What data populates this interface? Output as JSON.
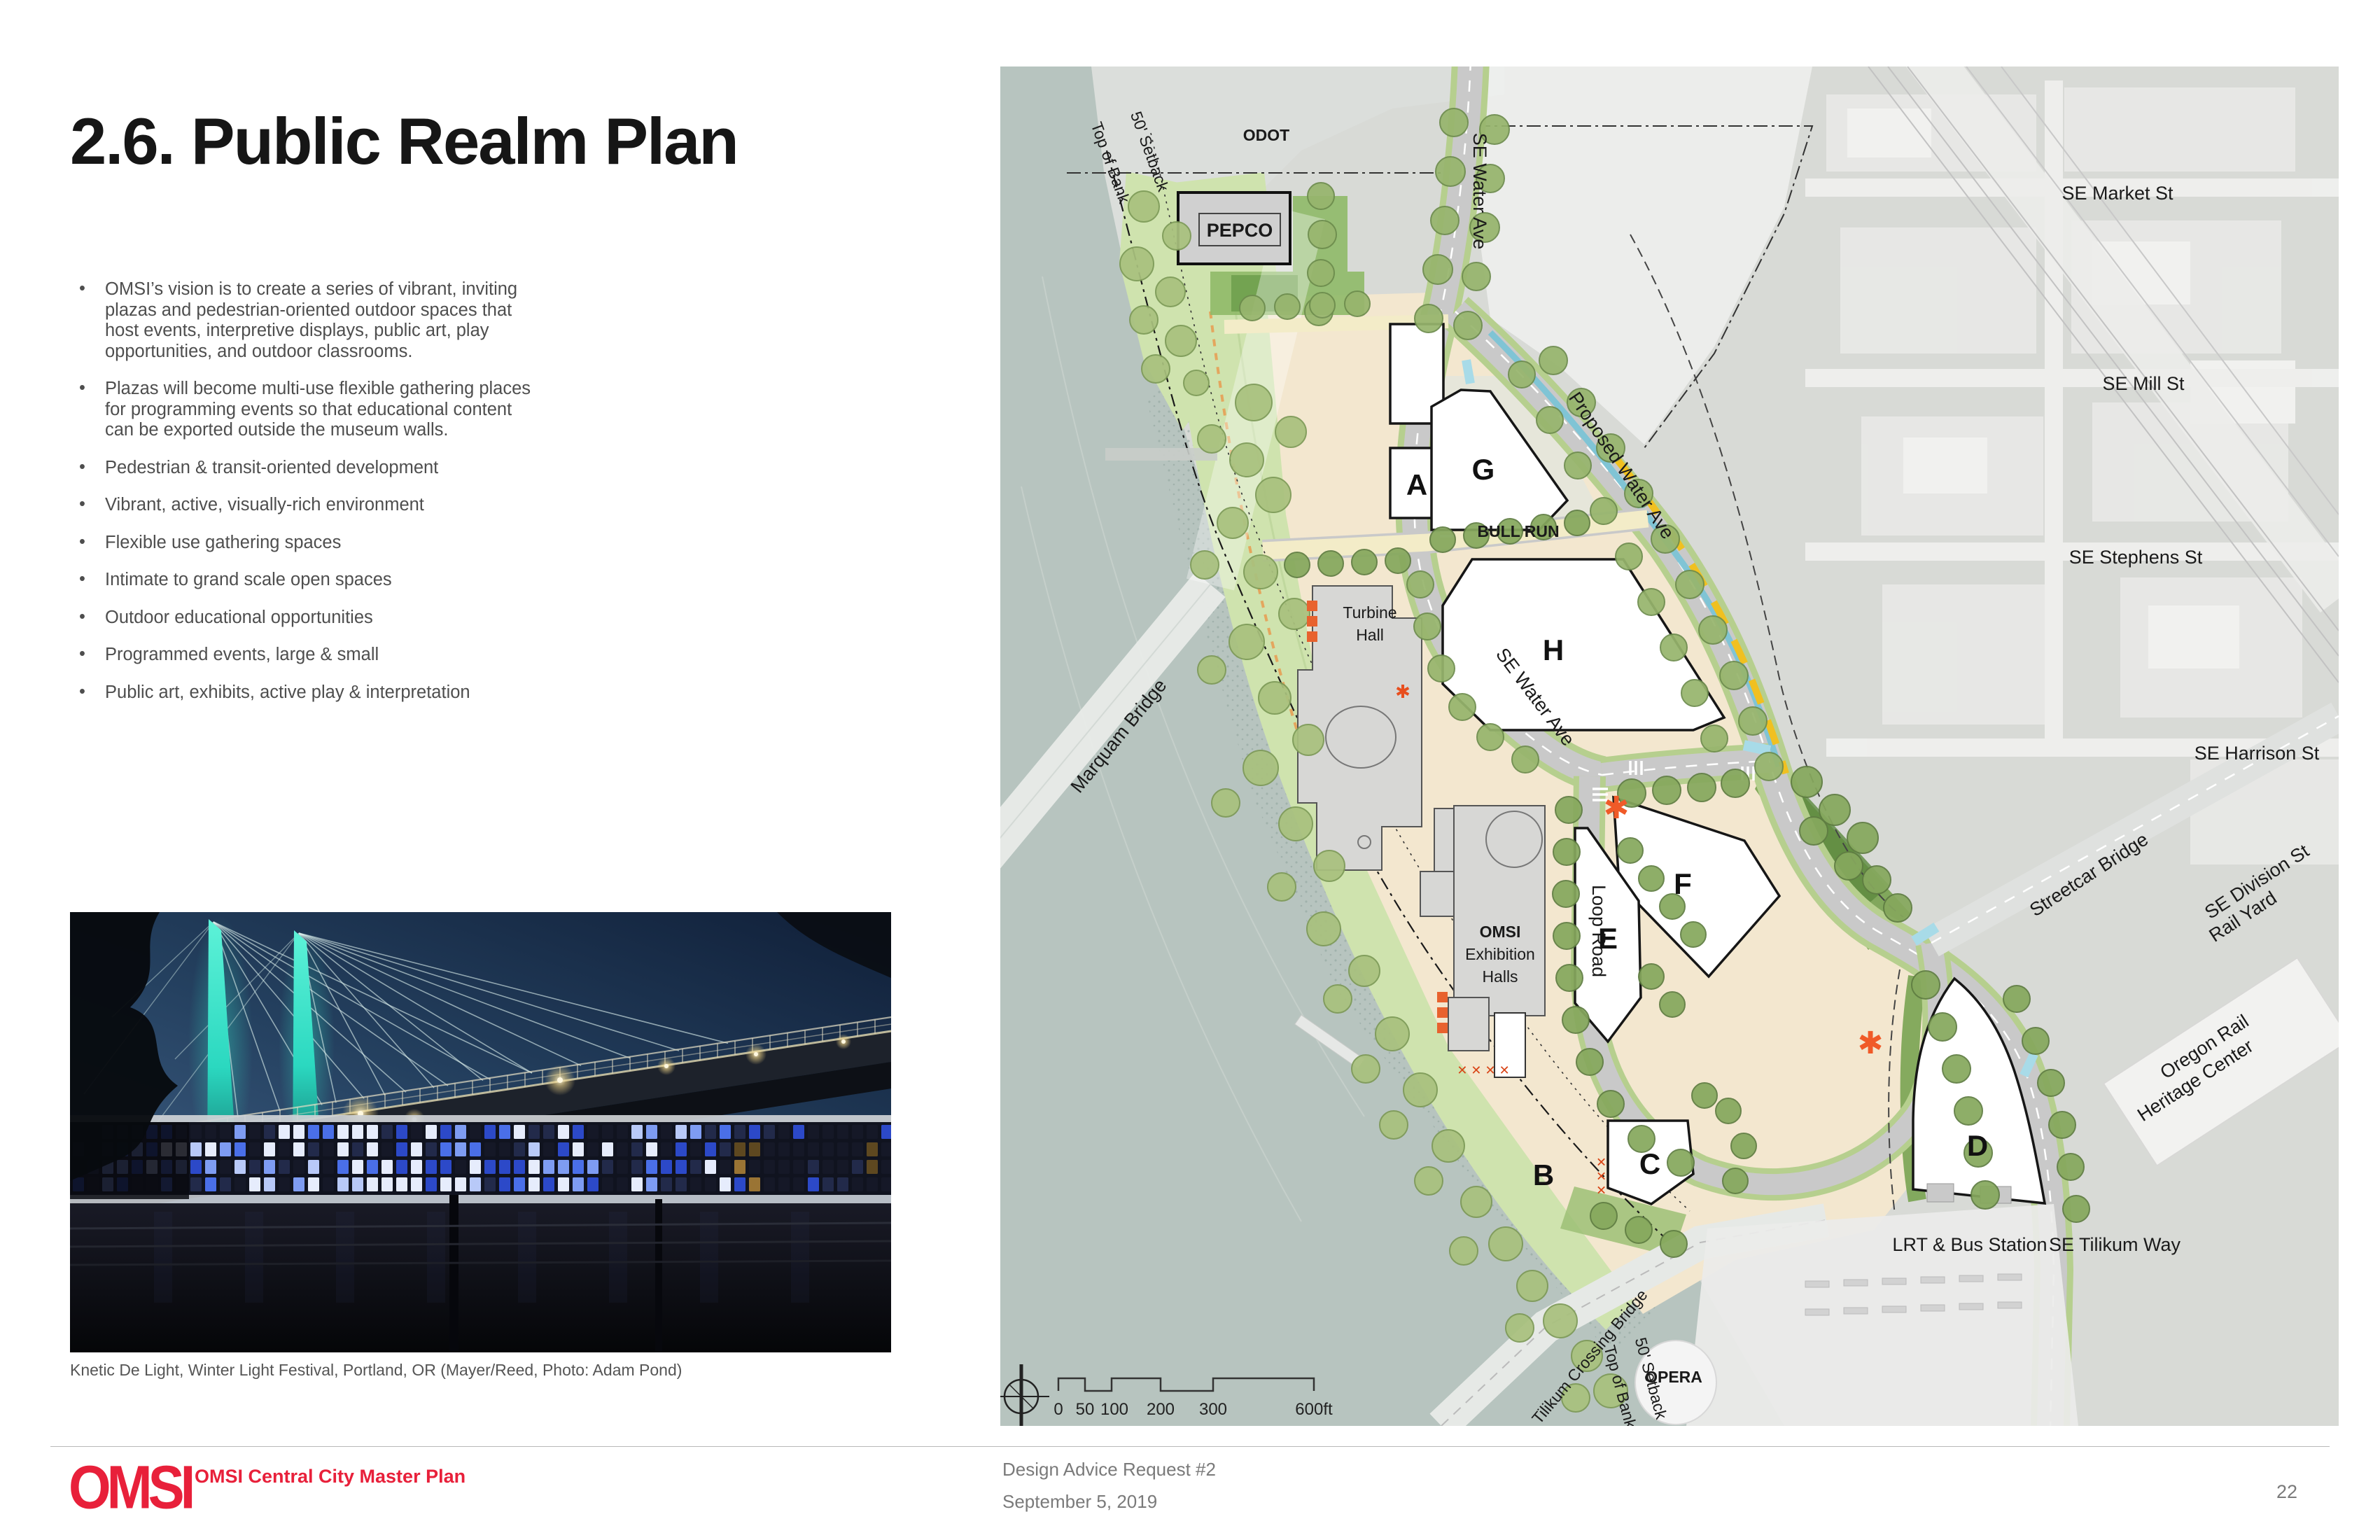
{
  "header": {
    "title": "2.6. Public Realm Plan"
  },
  "bullets": {
    "items": [
      "OMSI’s vision is to create a series of vibrant, inviting plazas and pedestrian-oriented outdoor spaces that host events, interpretive displays, public art, play opportunities, and outdoor classrooms.",
      "Plazas will become multi-use flexible gathering places for programming events so that educational content can be exported outside the museum walls.",
      "Pedestrian & transit-oriented development",
      "Vibrant, active, visually-rich environment",
      "Flexible use gathering spaces",
      "Intimate to grand scale open spaces",
      "Outdoor educational opportunities",
      "Programmed events, large & small",
      "Public art, exhibits, active play & interpretation"
    ]
  },
  "photo": {
    "caption": "Knetic De Light, Winter Light Festival, Portland, OR (Mayer/Reed, Photo: Adam Pond)"
  },
  "map": {
    "labels": {
      "odot": "ODOT",
      "pepco": "PEPCO",
      "se_water_ave_top": "SE Water Ave",
      "se_water_ave_mid": "SE Water Ave",
      "proposed_water_ave": "Proposed Water Ave",
      "bull_run": "BULL RUN",
      "loop_road": "Loop Road",
      "turbine_hall_1": "Turbine",
      "turbine_hall_2": "Hall",
      "omsi_1": "OMSI",
      "omsi_2": "Exhibition",
      "omsi_3": "Halls",
      "se_market_st": "SE Market St",
      "se_mill_st": "SE Mill St",
      "se_stephens_st": "SE Stephens St",
      "se_harrison_st": "SE Harrison St",
      "streetcar_bridge": "Streetcar Bridge",
      "se_division_st": "SE Division St",
      "rail_yard": "Rail Yard",
      "oregon_rail_1": "Oregon Rail",
      "oregon_rail_2": "Heritage Center",
      "se_tilikum_way": "SE Tilikum Way",
      "lrt_bus_station": "LRT  & Bus Station",
      "opera": "OPERA",
      "tilikum_crossing_bridge": "Tilikum Crossing Bridge",
      "marquam_bridge": "Marquam Bridge",
      "top_of_bank_north": "Top of Bank",
      "setback_north": "50' Setback",
      "top_of_bank_south": "Top of Bank",
      "setback_south": "50' Setback"
    },
    "buildings": {
      "a": "A",
      "b": "B",
      "c": "C",
      "d": "D",
      "e": "E",
      "f": "F",
      "g": "G",
      "h": "H"
    },
    "scale": {
      "ticks": [
        "0",
        "50",
        "100",
        "200",
        "300",
        "600ft"
      ]
    }
  },
  "footer": {
    "logo_text": "OMSI",
    "plan_title": "OMSI Central City Master Plan",
    "doc_title": "Design Advice Request #2",
    "doc_date": "September 5, 2019",
    "page_number": "22"
  },
  "colors": {
    "brand_red": "#e8203a",
    "river": "#b7c4bf",
    "greenway_green": "#cfe3ae",
    "campus_tan": "#f3e7cf",
    "transit_yellow": "#f0c020",
    "swale_blue": "#7cc4d6",
    "accent_orange": "#e8502a"
  }
}
